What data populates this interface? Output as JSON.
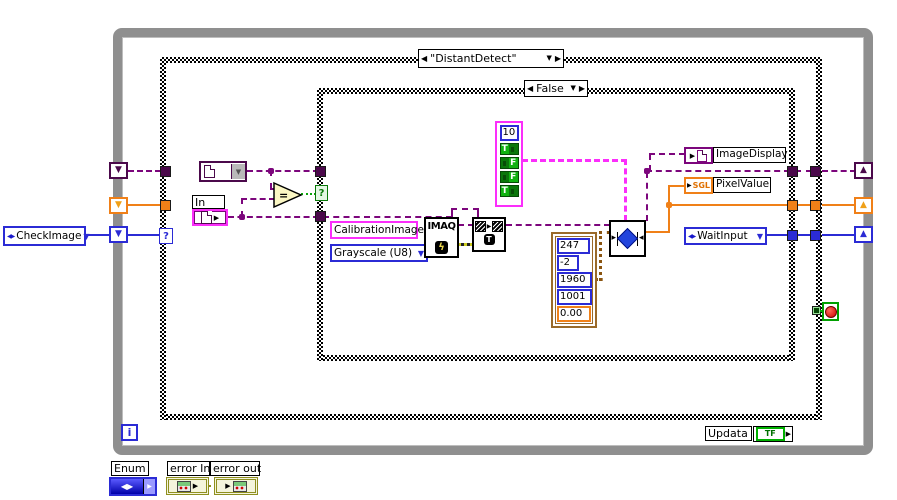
{
  "loop": {
    "i": "i",
    "updata_label": "Updata",
    "updata_value": "TF"
  },
  "cases": {
    "outer": {
      "label": "\"DistantDetect\"",
      "selector": "?"
    },
    "inner": {
      "label": "False",
      "selector": "?"
    }
  },
  "controls": {
    "check_image": "CheckImage",
    "wait_input": "WaitInput",
    "in_label": "In",
    "calibration_image": "CalibrationImage",
    "grayscale": "Grayscale (U8)"
  },
  "clusters": {
    "tf": {
      "number": "10",
      "bools": [
        "T",
        "F",
        "F",
        "T"
      ]
    },
    "params": [
      "247",
      "-2",
      "1960",
      "1001",
      "0.00"
    ]
  },
  "nodes": {
    "imaq": "IMAQ",
    "equals": "="
  },
  "indicators": {
    "image_display": "ImageDisplay",
    "pixel_value": "PixelValue",
    "pixel_value_type": "SGL"
  },
  "panel": {
    "enum_label": "Enum",
    "error_in": "error In",
    "error_out": "error out"
  },
  "icons": {
    "dropdown": "▼",
    "nav_prev": "◀",
    "nav_next": "▶",
    "enum_glyph": "◀▶",
    "arrow_right": "▶",
    "sr_down": "▼",
    "sr_up": "▲",
    "lightning": "ϟ",
    "copy_badge": "T",
    "tri_right": "▸",
    "tri_left": "◂"
  },
  "colors": {
    "image_wire": "#7c067c",
    "pink": "#fb2efb",
    "orange": "#f08018",
    "blue": "#2b2bd5",
    "green": "#0aa50a",
    "brown": "#8a5410",
    "olive": "#8f8f1f",
    "loop_gray": "#8f8f8f"
  }
}
